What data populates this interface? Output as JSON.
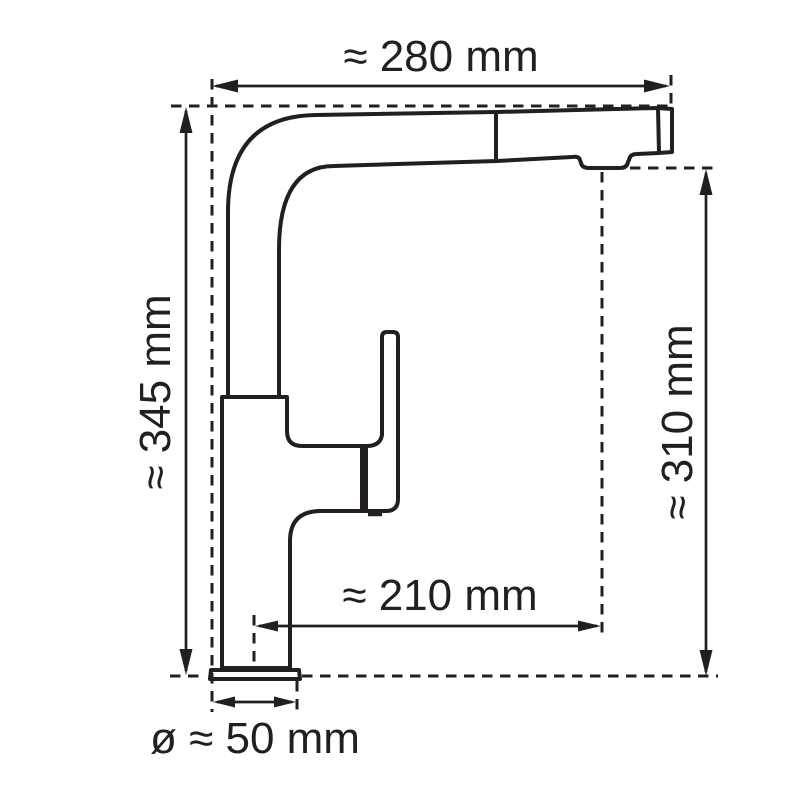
{
  "diagram": {
    "background_color": "#ffffff",
    "line_color": "#231f20",
    "dimensions": {
      "spout_width_label": "≈ 280 mm",
      "total_height_label": "≈ 345 mm",
      "outlet_height_label": "≈ 310 mm",
      "spout_reach_label": "≈ 210 mm",
      "base_diameter_label": "ø ≈ 50 mm"
    }
  }
}
